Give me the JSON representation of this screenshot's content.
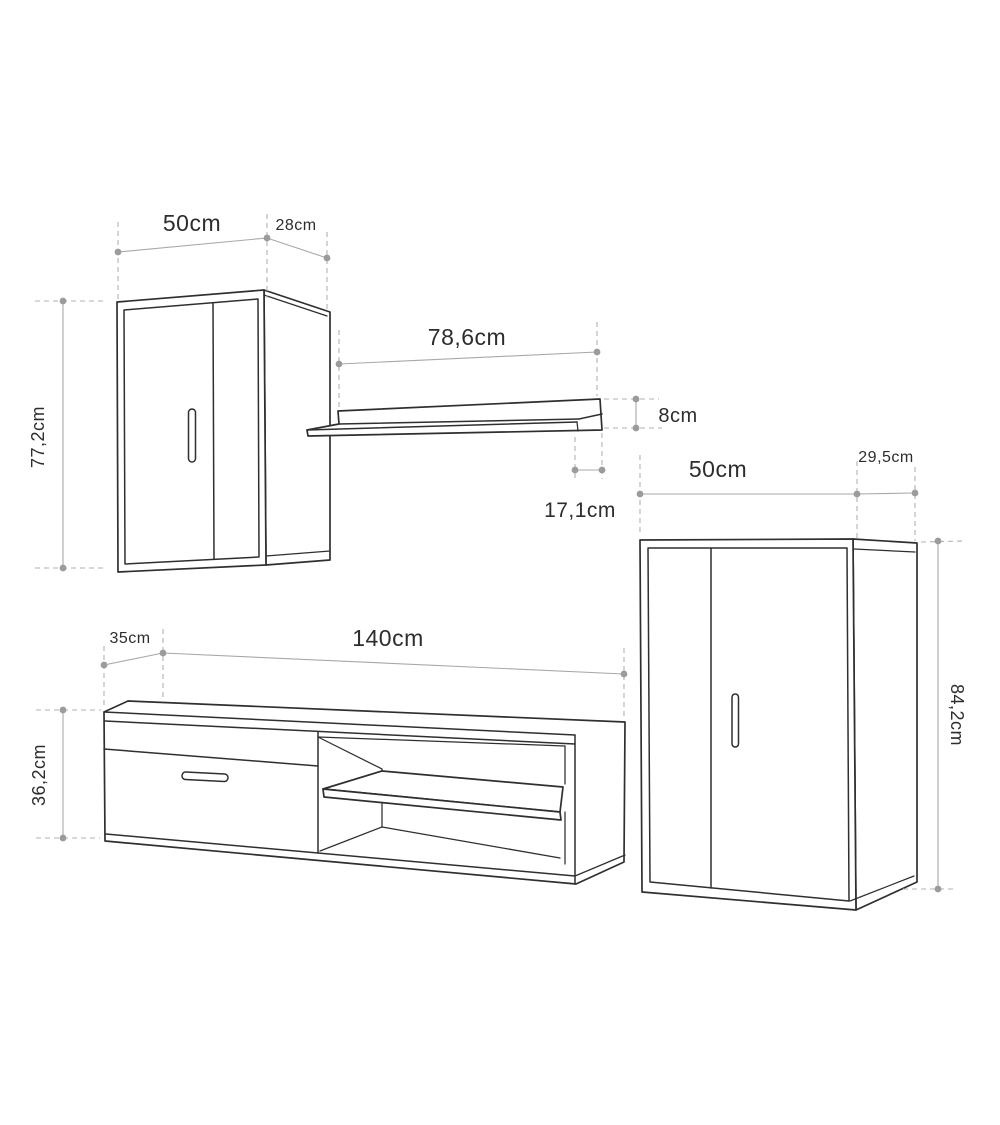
{
  "title": "Wall unit furniture dimensions diagram",
  "units": "cm",
  "colors": {
    "background": "#ffffff",
    "furniture_outline": "#2f2f2f",
    "dimension_line": "#a8a8a8",
    "dimension_dot": "#9b9b9b",
    "label_text": "#2d2d2d"
  },
  "pieces": [
    {
      "name": "wall-cabinet",
      "labels": {
        "width": "50cm",
        "depth": "28cm",
        "height": "77,2cm"
      }
    },
    {
      "name": "wall-shelf",
      "labels": {
        "width": "78,6cm",
        "height": "8cm",
        "depth": "17,1cm"
      }
    },
    {
      "name": "tall-cabinet",
      "labels": {
        "width": "50cm",
        "depth": "29,5cm",
        "height": "84,2cm"
      }
    },
    {
      "name": "tv-stand",
      "labels": {
        "width": "140cm",
        "depth": "35cm",
        "height": "36,2cm"
      }
    }
  ]
}
